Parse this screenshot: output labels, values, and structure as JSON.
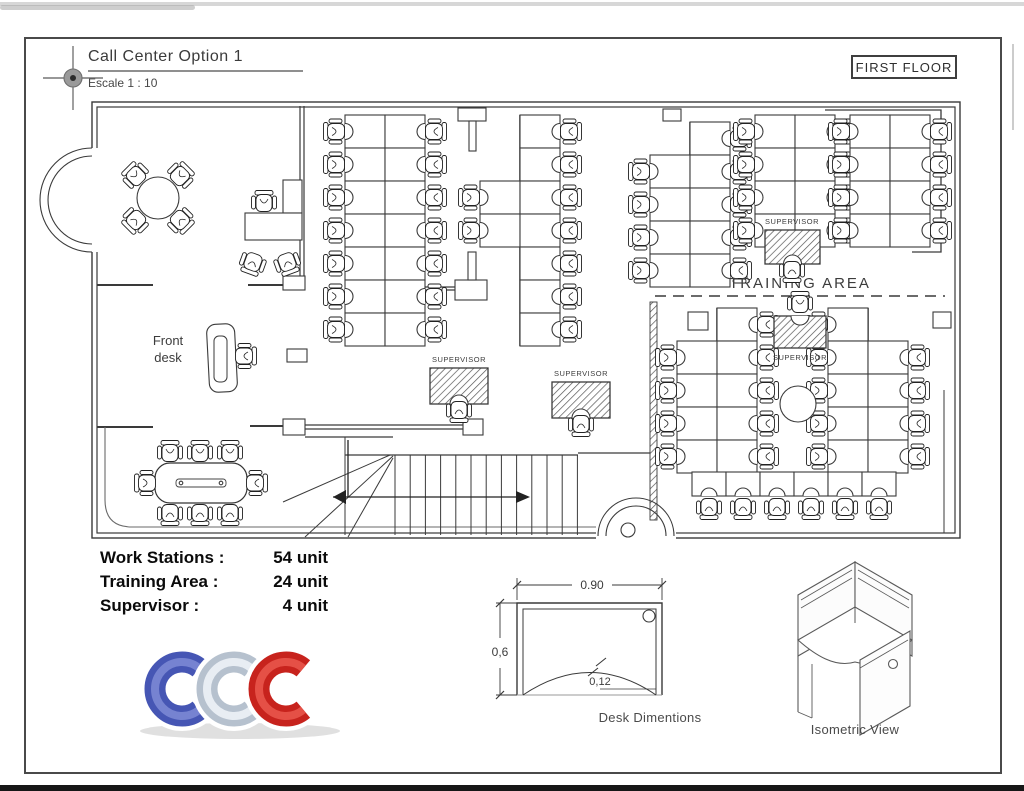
{
  "header": {
    "title": "Call Center Option 1",
    "scale": "Escale 1 : 10",
    "floor_label": "FIRST FLOOR"
  },
  "legend": {
    "rows": [
      {
        "label": "Work Stations :",
        "value": "54 unit"
      },
      {
        "label": "Training Area :",
        "value": "24 unit"
      },
      {
        "label": "Supervisor :",
        "value": "4 unit"
      }
    ]
  },
  "desk_dims": {
    "width": "0.90",
    "depth": "0,6",
    "cut": "0,12",
    "caption": "Desk Dimentions"
  },
  "isometric": {
    "caption": "Isometric View"
  },
  "logo": {
    "letters": [
      "C",
      "C",
      "C"
    ],
    "colors": [
      "#4656b4",
      "#b6c1ce",
      "#c7231d"
    ],
    "highlights": [
      "#7b88d4",
      "#edf2f7",
      "#e8554b"
    ]
  },
  "plan": {
    "area_labels": {
      "training_area": {
        "text": "TRAINING AREA",
        "x": 800,
        "y": 288,
        "size": 15
      },
      "front_desk": {
        "lines": [
          "Front",
          "desk"
        ],
        "x": 168,
        "y": 345,
        "size": 13
      },
      "supervisor_label": "SUPERVISOR"
    },
    "clusters": [
      {
        "cx": 385,
        "y0": 115,
        "rows": 7,
        "left": [
          0,
          1,
          2,
          3,
          4,
          5,
          6
        ],
        "right": [
          0,
          1,
          2,
          3,
          4,
          5,
          6
        ]
      },
      {
        "cx": 520,
        "y0": 115,
        "rows": 7,
        "left": [
          2,
          3
        ],
        "right": [
          0,
          1,
          2,
          3,
          4,
          5,
          6
        ]
      },
      {
        "cx": 690,
        "y0": 122,
        "rows": 5,
        "left": [
          1,
          2,
          3,
          4
        ],
        "right": [
          0,
          1,
          2,
          3,
          4
        ]
      },
      {
        "cx": 795,
        "y0": 115,
        "rows": 4,
        "left": [
          0,
          1,
          2,
          3
        ],
        "right": [
          0,
          1,
          2,
          3
        ]
      },
      {
        "cx": 890,
        "y0": 115,
        "rows": 4,
        "left": [
          0,
          1,
          2,
          3
        ],
        "right": [
          0,
          1,
          2,
          3
        ]
      }
    ],
    "training": {
      "columns": [
        {
          "cx": 717,
          "y0": 308,
          "rows": 5,
          "left": [
            1,
            2,
            3,
            4
          ],
          "right": [
            0,
            1,
            2,
            3,
            4
          ]
        },
        {
          "cx": 868,
          "y0": 308,
          "rows": 5,
          "left": [
            0,
            1,
            2,
            3,
            4
          ],
          "right": [
            1,
            2,
            3,
            4
          ]
        }
      ],
      "bottom_row": {
        "y": 472,
        "h": 24,
        "w": 34,
        "xs": [
          692,
          726,
          760,
          794,
          828,
          862
        ]
      },
      "pillar_circle": {
        "cx": 798,
        "cy": 404,
        "r": 18
      }
    },
    "supervisors": [
      {
        "desk": {
          "x": 430,
          "y": 368,
          "w": 58,
          "h": 36
        },
        "chair": {
          "x": 459,
          "y": 410,
          "rot": -90
        },
        "label": {
          "x": 459,
          "y": 362
        }
      },
      {
        "desk": {
          "x": 552,
          "y": 382,
          "w": 58,
          "h": 36
        },
        "chair": {
          "x": 581,
          "y": 424,
          "rot": -90
        },
        "label": {
          "x": 581,
          "y": 376
        }
      },
      {
        "desk": {
          "x": 765,
          "y": 230,
          "w": 55,
          "h": 34
        },
        "chair": {
          "x": 792,
          "y": 270,
          "rot": -90
        },
        "label": {
          "x": 792,
          "y": 224
        }
      },
      {
        "desk": {
          "x": 774,
          "y": 316,
          "w": 52,
          "h": 32
        },
        "chair": {
          "x": 800,
          "y": 304,
          "rot": 90
        },
        "label": {
          "x": 800,
          "y": 360
        }
      }
    ]
  }
}
